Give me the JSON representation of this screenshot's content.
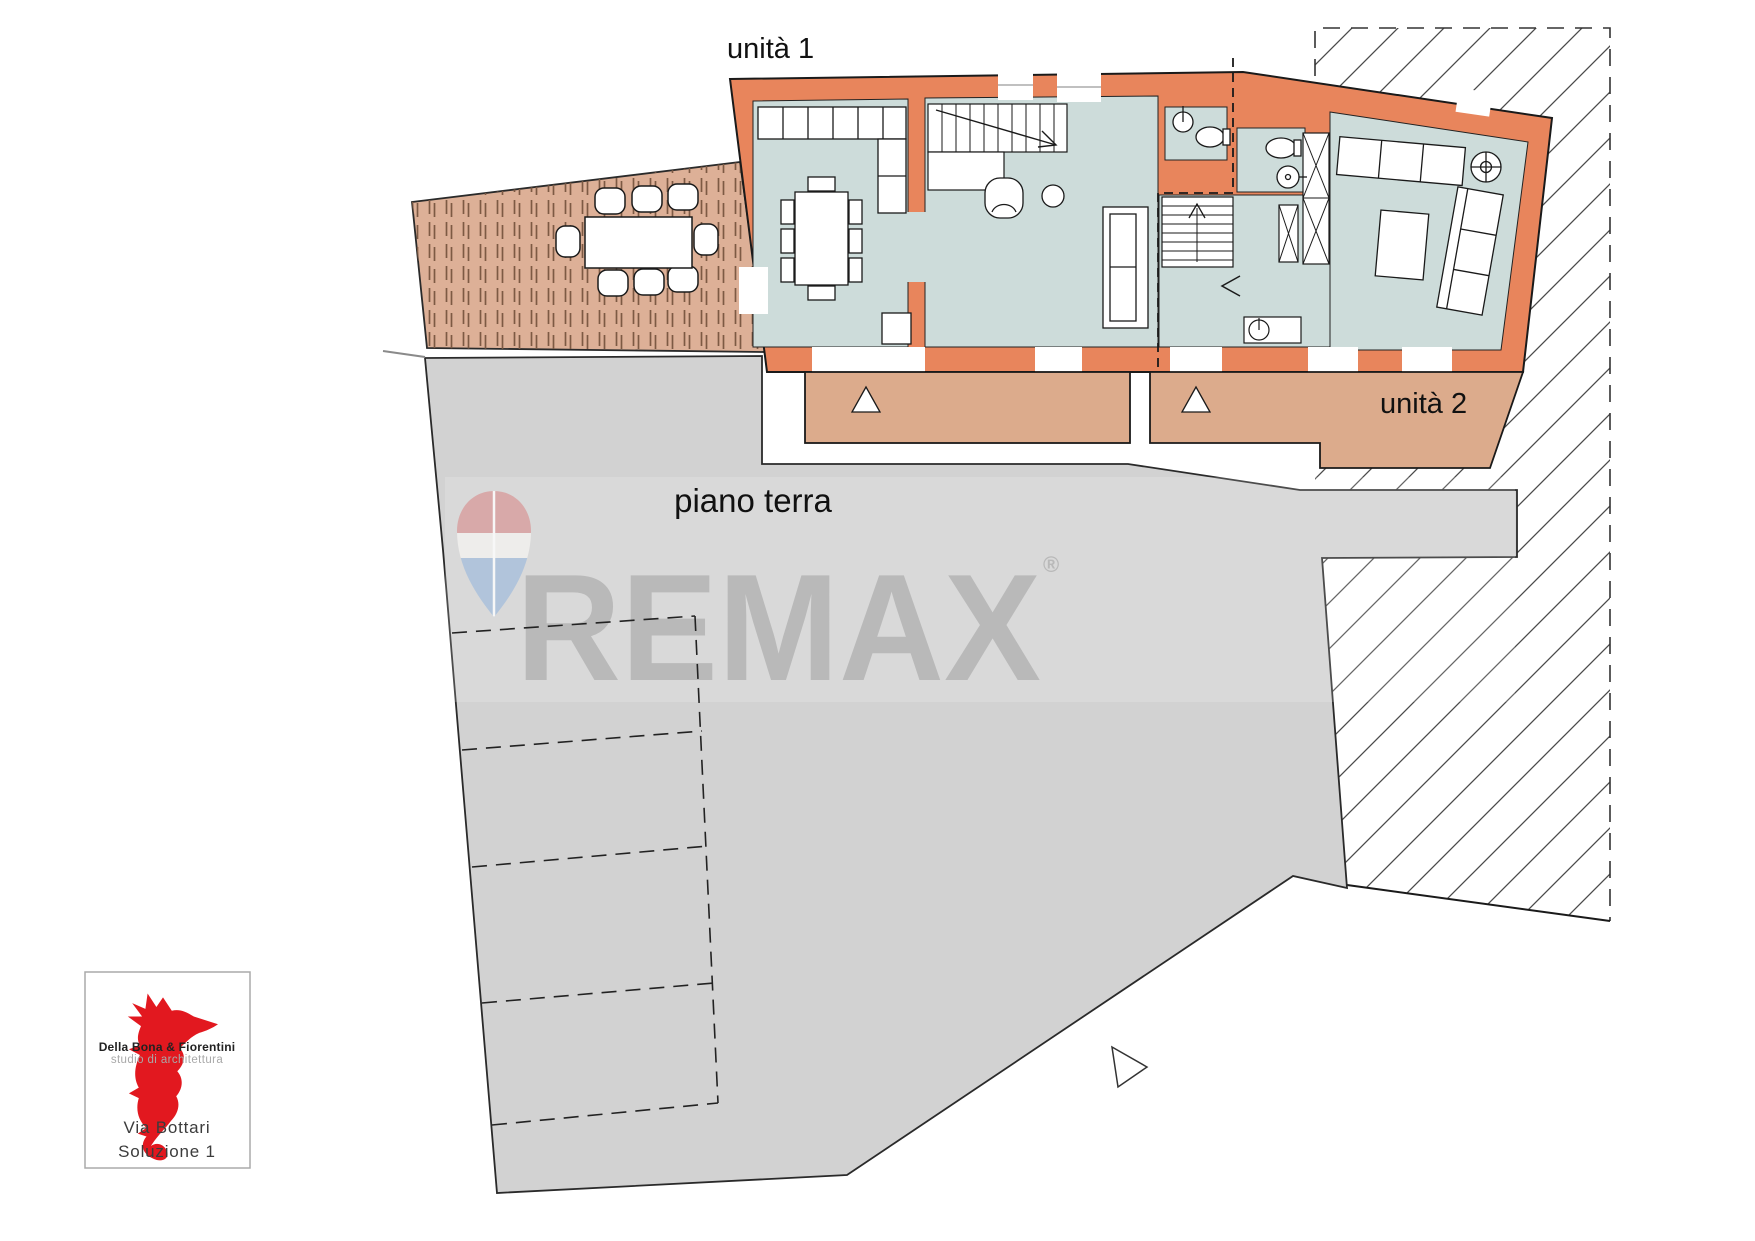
{
  "plan_labels": {
    "unit1": "unità 1",
    "unit2": "unità 2",
    "floor_name": "piano terra"
  },
  "watermark": {
    "brand": "REMAX",
    "registered_mark": "®",
    "text_color": "#adadad",
    "balloon_icon_colors": {
      "top": "#d89e9e",
      "middle": "#f4f2f0",
      "bottom": "#a8c0dc"
    }
  },
  "architect_logo": {
    "firm_name": "Della Bona & Fiorentini",
    "tagline": "studio di architettura",
    "project_street": "Via Bottari",
    "project_solution": "Soluzione 1",
    "seahorse_color": "#e2181f"
  },
  "plan_colors": {
    "walls": "#e8855c",
    "interior_floor": "#cddcda",
    "porch": "#dcab8c",
    "terrace": "#ddb097",
    "courtyard": "#d2d2d2",
    "outline": "#1a1a1a"
  }
}
